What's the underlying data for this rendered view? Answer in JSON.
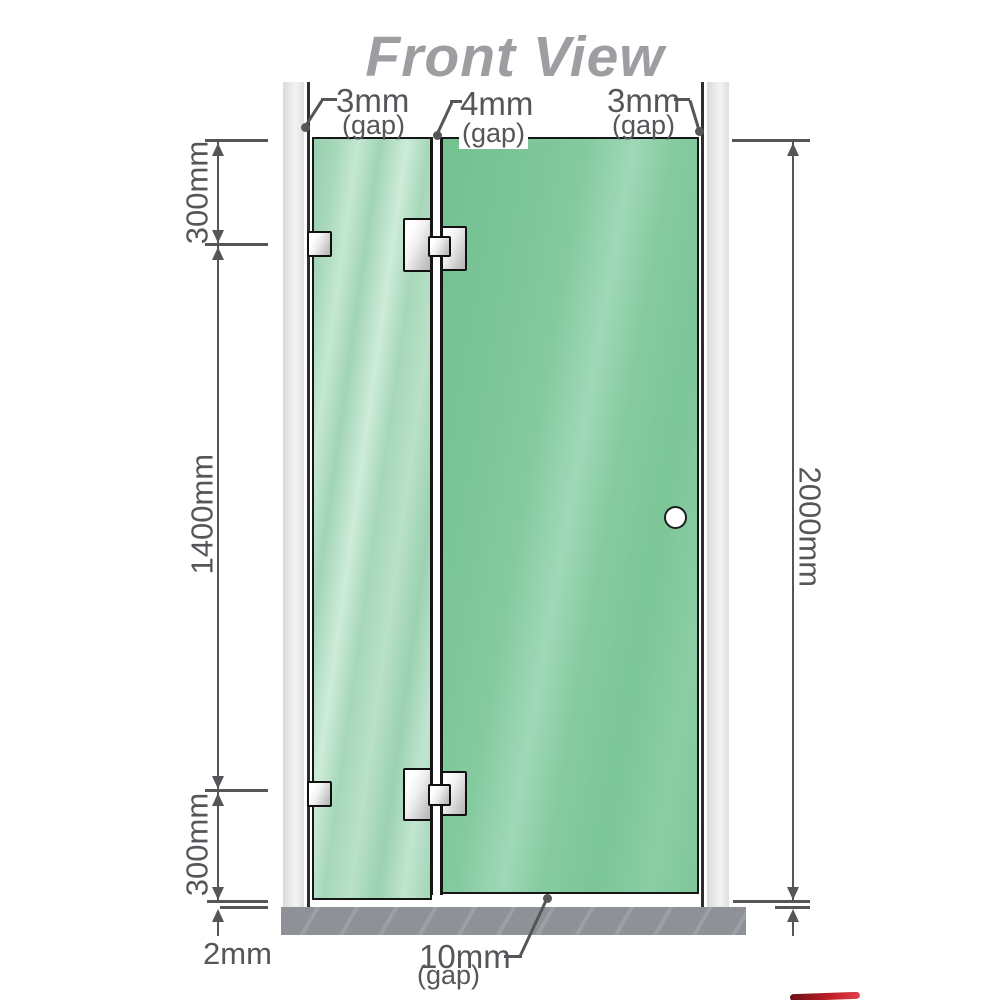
{
  "title": "Front View",
  "dimensions": {
    "left": {
      "top_segment": "300mm",
      "middle_segment": "1400mm",
      "bottom_segment": "300mm",
      "floor_gap": "2mm"
    },
    "right": {
      "total_height": "2000mm"
    },
    "gaps": {
      "left_wall": {
        "value": "3mm",
        "suffix": "(gap)"
      },
      "between_panels": {
        "value": "4mm",
        "suffix": "(gap)"
      },
      "right_wall": {
        "value": "3mm",
        "suffix": "(gap)"
      },
      "under_door": {
        "value": "10mm",
        "suffix": "(gap)"
      }
    }
  },
  "colors": {
    "fixed_panel_glass": "#a7d8bb",
    "door_panel_glass": "#7cc79b",
    "wall_post": "#e9e9e9",
    "floor_base": "#8f9296",
    "dimension_lines": "#54565a",
    "title_text": "#9c9ea1",
    "hinge_metal": "#e0e0e0",
    "logo_fragment_red": "#c41e26"
  }
}
